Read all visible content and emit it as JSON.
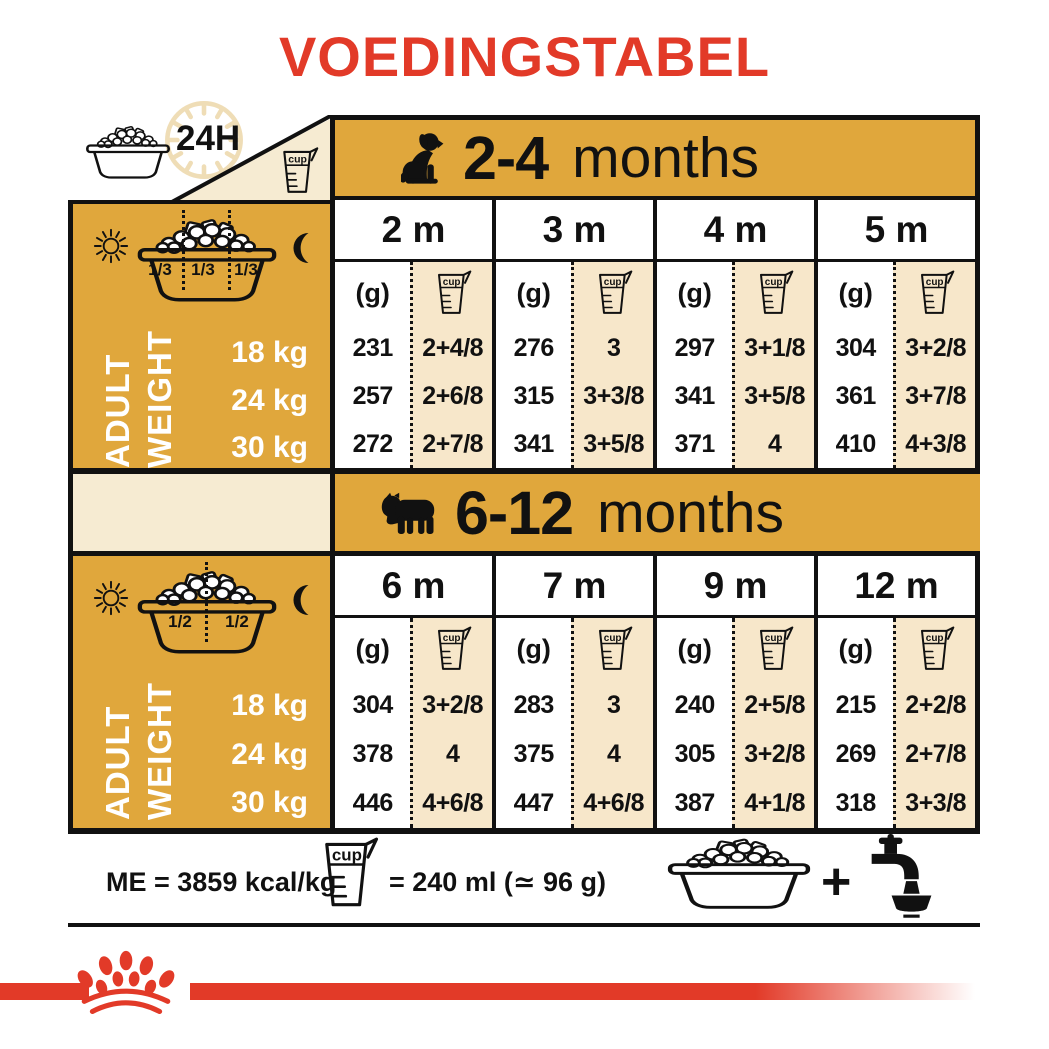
{
  "title": "VOEDINGSTABEL",
  "labels": {
    "h24": "24H",
    "cup": "cup",
    "g": "(g)",
    "plus": "+",
    "adult": "ADULT",
    "weight": "WEIGHT"
  },
  "weights": [
    "18 kg",
    "24 kg",
    "30 kg"
  ],
  "tables": [
    {
      "age": "2-4",
      "suffix": "months",
      "portions": [
        "1/3",
        "1/3",
        "1/3"
      ],
      "months": [
        "2 m",
        "3 m",
        "4 m",
        "5 m"
      ],
      "data": [
        {
          "g": [
            "231",
            "257",
            "272"
          ],
          "cup": [
            "2+4/8",
            "2+6/8",
            "2+7/8"
          ]
        },
        {
          "g": [
            "276",
            "315",
            "341"
          ],
          "cup": [
            "3",
            "3+3/8",
            "3+5/8"
          ]
        },
        {
          "g": [
            "297",
            "341",
            "371"
          ],
          "cup": [
            "3+1/8",
            "3+5/8",
            "4"
          ]
        },
        {
          "g": [
            "304",
            "361",
            "410"
          ],
          "cup": [
            "3+2/8",
            "3+7/8",
            "4+3/8"
          ]
        }
      ]
    },
    {
      "age": "6-12",
      "suffix": "months",
      "portions": [
        "1/2",
        "1/2"
      ],
      "months": [
        "6 m",
        "7 m",
        "9 m",
        "12 m"
      ],
      "data": [
        {
          "g": [
            "304",
            "378",
            "446"
          ],
          "cup": [
            "3+2/8",
            "4",
            "4+6/8"
          ]
        },
        {
          "g": [
            "283",
            "375",
            "447"
          ],
          "cup": [
            "3",
            "4",
            "4+6/8"
          ]
        },
        {
          "g": [
            "240",
            "305",
            "387"
          ],
          "cup": [
            "2+5/8",
            "3+2/8",
            "4+1/8"
          ]
        },
        {
          "g": [
            "215",
            "269",
            "318"
          ],
          "cup": [
            "2+2/8",
            "2+7/8",
            "3+3/8"
          ]
        }
      ]
    }
  ],
  "footer": {
    "me": "ME = 3859 kcal/kg",
    "cup_equiv": "= 240 ml (≃ 96 g)"
  },
  "icons": {
    "clock": "clock-24h-icon",
    "bowl": "kibble-bowl-icon",
    "cup": "measuring-cup-icon",
    "sun": "sun-icon",
    "moon": "moon-icon",
    "puppy": "puppy-silhouette-icon",
    "adult_dog": "bulldog-silhouette-icon",
    "tap": "water-tap-icon",
    "crown": "royal-canin-crown-logo"
  },
  "colors": {
    "red": "#E23A28",
    "gold": "#E0A73C",
    "cream": "#F6EBD2",
    "beige": "#F7E7CA",
    "black": "#111111"
  }
}
